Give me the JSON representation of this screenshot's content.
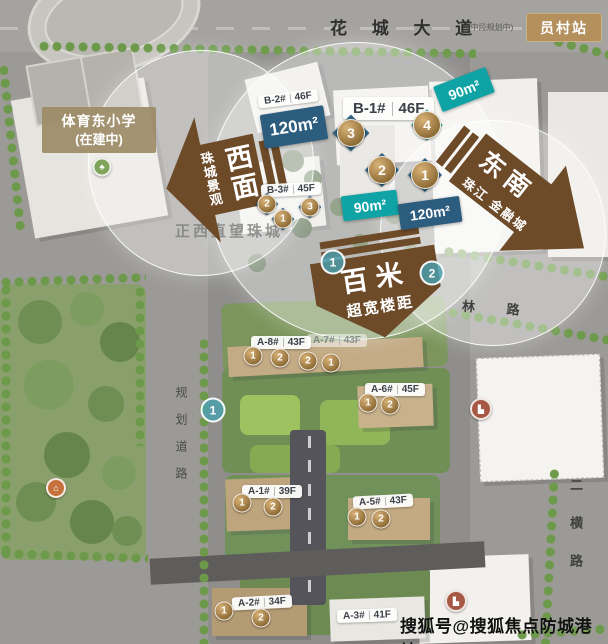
{
  "roads": {
    "top_name": "花 城 大 道",
    "top_note": "(中段规划中)",
    "east": "林 路",
    "southeast_vertical": "二横路",
    "west_vertical": "规划道路"
  },
  "station_badge": "员村站",
  "school_badge": {
    "line1": "体育东小学",
    "line2": "(在建中)"
  },
  "view_note": "正西直望珠城",
  "arrows": [
    {
      "id": "west",
      "title": "西面",
      "subtitle": "珠城景观"
    },
    {
      "id": "southeast",
      "title": "东南",
      "subtitle": "珠江 金融城"
    },
    {
      "id": "south",
      "title": "百米",
      "subtitle": "超宽楼距"
    }
  ],
  "area_tags": [
    "120m²",
    "90m²",
    "90m²",
    "120m²"
  ],
  "buildings": [
    {
      "name": "B-2#",
      "floors": "46F"
    },
    {
      "name": "B-1#",
      "floors": "46F"
    },
    {
      "name": "B-3#",
      "floors": "45F"
    },
    {
      "name": "A-8#",
      "floors": "43F"
    },
    {
      "name": "A-7#",
      "floors": "43F"
    },
    {
      "name": "A-6#",
      "floors": "45F"
    },
    {
      "name": "A-1#",
      "floors": "39F"
    },
    {
      "name": "A-5#",
      "floors": "43F"
    },
    {
      "name": "A-2#",
      "floors": "34F"
    },
    {
      "name": "A-3#",
      "floors": "41F"
    }
  ],
  "markers": {
    "b_big": [
      "3",
      "4",
      "2",
      "1"
    ],
    "b3": [
      "2",
      "1",
      "3"
    ],
    "a8": [
      "1",
      "2",
      "2",
      "1"
    ],
    "a6": [
      "1",
      "2"
    ],
    "a1": [
      "1",
      "2"
    ],
    "a5": [
      "1",
      "2"
    ],
    "a2": [
      "1",
      "2"
    ],
    "teal": [
      "1",
      "2",
      "1"
    ]
  },
  "icons": {
    "building_glyph": "▙",
    "pavilion_glyph": "⌂",
    "tree_glyph": "♣"
  },
  "watermark": "搜狐号@搜狐焦点防城港站",
  "colors": {
    "arrow_brown": "#6d4a28",
    "tag_blue": "#2d5d7e",
    "tag_teal": "#0fa3a6",
    "badge_tan": "#b3905c",
    "bronze": "#b98d52",
    "view_circle": "rgba(255,255,255,0.38)"
  }
}
